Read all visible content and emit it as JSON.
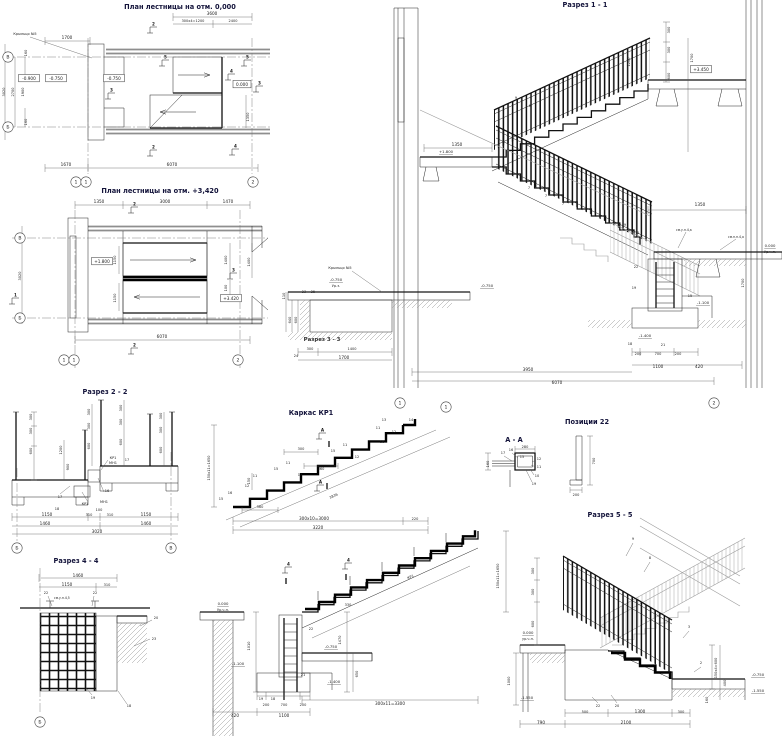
{
  "canvas": {
    "width": 782,
    "height": 737,
    "background": "#ffffff",
    "ink": "#1c1c1c",
    "wall_gray": "#8e8e8e",
    "title_color": "#13133a"
  },
  "labels": [
    {
      "t": "План лестницы на отм. 0,000",
      "x": 180,
      "y": 9,
      "c": "t",
      "n": "title-plan-0"
    },
    {
      "t": "План лестницы на отм. +3,420",
      "x": 160,
      "y": 193,
      "c": "t",
      "n": "title-plan-3420"
    },
    {
      "t": "Разрез 1 - 1",
      "x": 585,
      "y": 7,
      "c": "t",
      "n": "title-section-1-1"
    },
    {
      "t": "Разрез 2 - 2",
      "x": 105,
      "y": 394,
      "c": "t",
      "n": "title-section-2-2"
    },
    {
      "t": "Каркас КР1",
      "x": 311,
      "y": 415,
      "c": "t",
      "n": "title-frame-kr1"
    },
    {
      "t": "А - А",
      "x": 514,
      "y": 442,
      "c": "t",
      "n": "title-detail-a-a"
    },
    {
      "t": "Позиции 22",
      "x": 587,
      "y": 424,
      "c": "t",
      "n": "title-positions-22"
    },
    {
      "t": "Разрез 4 - 4",
      "x": 76,
      "y": 563,
      "c": "t",
      "n": "title-section-4-4"
    },
    {
      "t": "Разрез 5 - 5",
      "x": 610,
      "y": 517,
      "c": "t",
      "n": "title-section-5-5"
    },
    {
      "t": "Разрез 3 - 3",
      "x": 322,
      "y": 341,
      "c": "t2",
      "n": "title-section-3-3"
    },
    {
      "t": "Крыльцо №5",
      "x": 25,
      "y": 35,
      "c": "s"
    },
    {
      "t": "3600",
      "x": 212,
      "y": 15,
      "c": "d"
    },
    {
      "t": "300х4=1200",
      "x": 193,
      "y": 22,
      "c": "s"
    },
    {
      "t": "2400",
      "x": 233,
      "y": 22,
      "c": "s"
    },
    {
      "t": "1700",
      "x": 67,
      "y": 39,
      "c": "d"
    },
    {
      "t": "1670",
      "x": 66,
      "y": 166,
      "c": "d"
    },
    {
      "t": "6070",
      "x": 172,
      "y": 166,
      "c": "d"
    },
    {
      "t": "3020",
      "x": 5,
      "y": 92,
      "c": "s",
      "r": -90
    },
    {
      "t": "2700",
      "x": 14,
      "y": 92,
      "c": "s",
      "r": -90
    },
    {
      "t": "1900",
      "x": 24,
      "y": 92,
      "c": "s",
      "r": -90
    },
    {
      "t": "160",
      "x": 27,
      "y": 53,
      "c": "s",
      "r": -90
    },
    {
      "t": "160",
      "x": 27,
      "y": 122,
      "c": "s",
      "r": -90
    },
    {
      "t": "1350",
      "x": 249,
      "y": 117,
      "c": "s",
      "r": -90
    },
    {
      "t": "1350",
      "x": 99,
      "y": 203,
      "c": "d"
    },
    {
      "t": "3000",
      "x": 165,
      "y": 203,
      "c": "d"
    },
    {
      "t": "1470",
      "x": 228,
      "y": 203,
      "c": "d"
    },
    {
      "t": "1150",
      "x": 116,
      "y": 260,
      "c": "s",
      "r": -90
    },
    {
      "t": "1150",
      "x": 116,
      "y": 298,
      "c": "s",
      "r": -90
    },
    {
      "t": "1400",
      "x": 227,
      "y": 260,
      "c": "s",
      "r": -90
    },
    {
      "t": "1400",
      "x": 250,
      "y": 262,
      "c": "s",
      "r": -90
    },
    {
      "t": "100",
      "x": 227,
      "y": 288,
      "c": "s",
      "r": -90
    },
    {
      "t": "3020",
      "x": 21,
      "y": 276,
      "c": "s",
      "r": -90
    },
    {
      "t": "6070",
      "x": 162,
      "y": 338,
      "c": "d"
    },
    {
      "t": "1350",
      "x": 457,
      "y": 146,
      "c": "d"
    },
    {
      "t": "+1.800",
      "x": 446,
      "y": 153,
      "c": "e"
    },
    {
      "t": "0.000",
      "x": 770,
      "y": 247,
      "c": "e"
    },
    {
      "t": "Ур.ч.п.",
      "x": 770,
      "y": 253,
      "c": "s"
    },
    {
      "t": "1350",
      "x": 700,
      "y": 206,
      "c": "d"
    },
    {
      "t": "см.у.п.4,а",
      "x": 676,
      "y": 231,
      "c": "n"
    },
    {
      "t": "см.п.п.4,а",
      "x": 728,
      "y": 238,
      "c": "n"
    },
    {
      "t": "Крыльцо №5",
      "x": 340,
      "y": 269,
      "c": "s"
    },
    {
      "t": "-0.750",
      "x": 336,
      "y": 281,
      "c": "e"
    },
    {
      "t": "Ур.з.",
      "x": 336,
      "y": 287,
      "c": "s"
    },
    {
      "t": "-0.750",
      "x": 487,
      "y": 287,
      "c": "e"
    },
    {
      "t": "300",
      "x": 310,
      "y": 350,
      "c": "s"
    },
    {
      "t": "1400",
      "x": 352,
      "y": 350,
      "c": "s"
    },
    {
      "t": "1700",
      "x": 344,
      "y": 359,
      "c": "d"
    },
    {
      "t": "110",
      "x": 285,
      "y": 296,
      "c": "s",
      "r": -90
    },
    {
      "t": "640",
      "x": 291,
      "y": 320,
      "c": "s",
      "r": -90
    },
    {
      "t": "600",
      "x": 297,
      "y": 320,
      "c": "s",
      "r": -90
    },
    {
      "t": "23",
      "x": 304,
      "y": 293,
      "c": "s"
    },
    {
      "t": "25",
      "x": 313,
      "y": 293,
      "c": "s"
    },
    {
      "t": "24",
      "x": 296,
      "y": 357,
      "c": "s"
    },
    {
      "t": "-1.100",
      "x": 703,
      "y": 304,
      "c": "e"
    },
    {
      "t": "-1.400",
      "x": 645,
      "y": 337,
      "c": "e"
    },
    {
      "t": "200",
      "x": 638,
      "y": 355,
      "c": "s"
    },
    {
      "t": "700",
      "x": 658,
      "y": 355,
      "c": "s"
    },
    {
      "t": "200",
      "x": 678,
      "y": 355,
      "c": "s"
    },
    {
      "t": "1100",
      "x": 658,
      "y": 368,
      "c": "d"
    },
    {
      "t": "420",
      "x": 699,
      "y": 368,
      "c": "d"
    },
    {
      "t": "3950",
      "x": 528,
      "y": 371,
      "c": "d"
    },
    {
      "t": "6070",
      "x": 557,
      "y": 384,
      "c": "d"
    },
    {
      "t": "300",
      "x": 670,
      "y": 30,
      "c": "s",
      "r": -90
    },
    {
      "t": "300",
      "x": 670,
      "y": 50,
      "c": "s",
      "r": -90
    },
    {
      "t": "600",
      "x": 670,
      "y": 76,
      "c": "s",
      "r": -90
    },
    {
      "t": "1700",
      "x": 693,
      "y": 58,
      "c": "s",
      "r": -90
    },
    {
      "t": "1200",
      "x": 630,
      "y": 62,
      "c": "s",
      "r": -90
    },
    {
      "t": "1700",
      "x": 744,
      "y": 283,
      "c": "s",
      "r": -90
    },
    {
      "t": "9",
      "x": 516,
      "y": 99,
      "c": "s"
    },
    {
      "t": "8",
      "x": 530,
      "y": 107,
      "c": "s"
    },
    {
      "t": "9",
      "x": 625,
      "y": 226,
      "c": "s"
    },
    {
      "t": "8",
      "x": 638,
      "y": 234,
      "c": "s"
    },
    {
      "t": "7",
      "x": 529,
      "y": 189,
      "c": "s"
    },
    {
      "t": "7",
      "x": 546,
      "y": 197,
      "c": "s"
    },
    {
      "t": "7",
      "x": 563,
      "y": 205,
      "c": "s"
    },
    {
      "t": "22",
      "x": 636,
      "y": 268,
      "c": "s"
    },
    {
      "t": "19",
      "x": 634,
      "y": 289,
      "c": "s"
    },
    {
      "t": "15",
      "x": 690,
      "y": 297,
      "c": "s"
    },
    {
      "t": "21",
      "x": 663,
      "y": 346,
      "c": "s"
    },
    {
      "t": "18",
      "x": 630,
      "y": 345,
      "c": "s"
    },
    {
      "t": "300",
      "x": 32,
      "y": 417,
      "c": "s",
      "r": -90
    },
    {
      "t": "300",
      "x": 32,
      "y": 431,
      "c": "s",
      "r": -90
    },
    {
      "t": "600",
      "x": 32,
      "y": 451,
      "c": "s",
      "r": -90
    },
    {
      "t": "1200",
      "x": 62,
      "y": 450,
      "c": "s",
      "r": -90
    },
    {
      "t": "900",
      "x": 69,
      "y": 467,
      "c": "s",
      "r": -90
    },
    {
      "t": "300",
      "x": 90,
      "y": 412,
      "c": "s",
      "r": -90
    },
    {
      "t": "300",
      "x": 90,
      "y": 426,
      "c": "s",
      "r": -90
    },
    {
      "t": "600",
      "x": 90,
      "y": 446,
      "c": "s",
      "r": -90
    },
    {
      "t": "300",
      "x": 122,
      "y": 408,
      "c": "s",
      "r": -90
    },
    {
      "t": "300",
      "x": 122,
      "y": 422,
      "c": "s",
      "r": -90
    },
    {
      "t": "600",
      "x": 122,
      "y": 442,
      "c": "s",
      "r": -90
    },
    {
      "t": "300",
      "x": 162,
      "y": 416,
      "c": "s",
      "r": -90
    },
    {
      "t": "300",
      "x": 162,
      "y": 430,
      "c": "s",
      "r": -90
    },
    {
      "t": "600",
      "x": 162,
      "y": 450,
      "c": "s",
      "r": -90
    },
    {
      "t": "КР1",
      "x": 113,
      "y": 459,
      "c": "s"
    },
    {
      "t": "МН1",
      "x": 113,
      "y": 464,
      "c": "s"
    },
    {
      "t": "17",
      "x": 127,
      "y": 461,
      "c": "s"
    },
    {
      "t": "16",
      "x": 107,
      "y": 492,
      "c": "s"
    },
    {
      "t": "МН1",
      "x": 104,
      "y": 503,
      "c": "s"
    },
    {
      "t": "КР1",
      "x": 85,
      "y": 505,
      "c": "s"
    },
    {
      "t": "17",
      "x": 60,
      "y": 498,
      "c": "s"
    },
    {
      "t": "18",
      "x": 57,
      "y": 510,
      "c": "s"
    },
    {
      "t": "1150",
      "x": 47,
      "y": 516,
      "c": "d"
    },
    {
      "t": "310",
      "x": 89,
      "y": 516,
      "c": "s"
    },
    {
      "t": "100",
      "x": 99,
      "y": 511,
      "c": "s"
    },
    {
      "t": "310",
      "x": 110,
      "y": 516,
      "c": "s"
    },
    {
      "t": "1150",
      "x": 146,
      "y": 516,
      "c": "d"
    },
    {
      "t": "1460",
      "x": 45,
      "y": 525,
      "c": "d"
    },
    {
      "t": "1460",
      "x": 146,
      "y": 525,
      "c": "d"
    },
    {
      "t": "3020",
      "x": 97,
      "y": 533,
      "c": "d"
    },
    {
      "t": "150х11=1650",
      "x": 210,
      "y": 468,
      "c": "s",
      "r": -90
    },
    {
      "t": "300х10=3000",
      "x": 314,
      "y": 520,
      "c": "d"
    },
    {
      "t": "3220",
      "x": 318,
      "y": 529,
      "c": "d"
    },
    {
      "t": "220",
      "x": 415,
      "y": 520,
      "c": "s"
    },
    {
      "t": "3836",
      "x": 334,
      "y": 497,
      "c": "s",
      "r": -24
    },
    {
      "t": "300",
      "x": 301,
      "y": 450,
      "c": "s"
    },
    {
      "t": "360",
      "x": 321,
      "y": 470,
      "c": "s"
    },
    {
      "t": "360",
      "x": 260,
      "y": 508,
      "c": "s"
    },
    {
      "t": "150",
      "x": 250,
      "y": 481,
      "c": "s",
      "r": -90
    },
    {
      "t": "15",
      "x": 221,
      "y": 500,
      "c": "s"
    },
    {
      "t": "16",
      "x": 230,
      "y": 494,
      "c": "s"
    },
    {
      "t": "12",
      "x": 247,
      "y": 487,
      "c": "s"
    },
    {
      "t": "11",
      "x": 255,
      "y": 477,
      "c": "s"
    },
    {
      "t": "15",
      "x": 276,
      "y": 470,
      "c": "s"
    },
    {
      "t": "11",
      "x": 288,
      "y": 464,
      "c": "s"
    },
    {
      "t": "12",
      "x": 300,
      "y": 476,
      "c": "s"
    },
    {
      "t": "15",
      "x": 333,
      "y": 452,
      "c": "s"
    },
    {
      "t": "11",
      "x": 345,
      "y": 446,
      "c": "s"
    },
    {
      "t": "12",
      "x": 357,
      "y": 458,
      "c": "s"
    },
    {
      "t": "13",
      "x": 384,
      "y": 421,
      "c": "s"
    },
    {
      "t": "11",
      "x": 378,
      "y": 429,
      "c": "s"
    },
    {
      "t": "12",
      "x": 394,
      "y": 433,
      "c": "s"
    },
    {
      "t": "14",
      "x": 411,
      "y": 421,
      "c": "s"
    },
    {
      "t": "16",
      "x": 382,
      "y": 443,
      "c": "s"
    },
    {
      "t": "280",
      "x": 525,
      "y": 448,
      "c": "s"
    },
    {
      "t": "160",
      "x": 489,
      "y": 464,
      "c": "s",
      "r": -90
    },
    {
      "t": "17",
      "x": 503,
      "y": 454,
      "c": "s"
    },
    {
      "t": "16",
      "x": 511,
      "y": 451,
      "c": "s"
    },
    {
      "t": "15",
      "x": 522,
      "y": 458,
      "c": "s"
    },
    {
      "t": "12",
      "x": 539,
      "y": 460,
      "c": "s"
    },
    {
      "t": "11",
      "x": 539,
      "y": 468,
      "c": "s"
    },
    {
      "t": "10",
      "x": 537,
      "y": 477,
      "c": "s"
    },
    {
      "t": "19",
      "x": 534,
      "y": 485,
      "c": "s"
    },
    {
      "t": "700",
      "x": 595,
      "y": 461,
      "c": "s",
      "r": -90
    },
    {
      "t": "200",
      "x": 576,
      "y": 496,
      "c": "s"
    },
    {
      "t": "0.000",
      "x": 223,
      "y": 605,
      "c": "e"
    },
    {
      "t": "Ур.ч.п.",
      "x": 223,
      "y": 611,
      "c": "s"
    },
    {
      "t": "-1.100",
      "x": 238,
      "y": 665,
      "c": "e"
    },
    {
      "t": "-0.750",
      "x": 331,
      "y": 648,
      "c": "e"
    },
    {
      "t": "-1.400",
      "x": 334,
      "y": 683,
      "c": "e"
    },
    {
      "t": "1010",
      "x": 250,
      "y": 646,
      "c": "s",
      "r": -90
    },
    {
      "t": "1470",
      "x": 341,
      "y": 640,
      "c": "s",
      "r": -90
    },
    {
      "t": "650",
      "x": 358,
      "y": 674,
      "c": "s",
      "r": -90
    },
    {
      "t": "330",
      "x": 348,
      "y": 606,
      "c": "s"
    },
    {
      "t": "200",
      "x": 266,
      "y": 706,
      "c": "s"
    },
    {
      "t": "700",
      "x": 284,
      "y": 706,
      "c": "s"
    },
    {
      "t": "200",
      "x": 303,
      "y": 706,
      "c": "s"
    },
    {
      "t": "420",
      "x": 235,
      "y": 717,
      "c": "d"
    },
    {
      "t": "1100",
      "x": 284,
      "y": 717,
      "c": "d"
    },
    {
      "t": "300х11=3300",
      "x": 390,
      "y": 705,
      "c": "d"
    },
    {
      "t": "150х11=1650",
      "x": 499,
      "y": 576,
      "c": "s",
      "r": -90
    },
    {
      "t": "КР1",
      "x": 411,
      "y": 578,
      "c": "s",
      "r": -24
    },
    {
      "t": "1000",
      "x": 510,
      "y": 681,
      "c": "s",
      "r": -90
    },
    {
      "t": "22",
      "x": 311,
      "y": 630,
      "c": "s"
    },
    {
      "t": "19",
      "x": 261,
      "y": 700,
      "c": "s"
    },
    {
      "t": "18",
      "x": 273,
      "y": 700,
      "c": "s"
    },
    {
      "t": "21",
      "x": 303,
      "y": 676,
      "c": "s"
    },
    {
      "t": "1460",
      "x": 78,
      "y": 577,
      "c": "d"
    },
    {
      "t": "1150",
      "x": 67,
      "y": 586,
      "c": "d"
    },
    {
      "t": "310",
      "x": 107,
      "y": 586,
      "c": "s"
    },
    {
      "t": "22",
      "x": 46,
      "y": 594,
      "c": "s"
    },
    {
      "t": "см.у.п.4,5",
      "x": 54,
      "y": 599,
      "c": "n"
    },
    {
      "t": "22",
      "x": 95,
      "y": 594,
      "c": "s"
    },
    {
      "t": "20",
      "x": 156,
      "y": 619,
      "c": "s"
    },
    {
      "t": "23",
      "x": 154,
      "y": 640,
      "c": "s"
    },
    {
      "t": "19",
      "x": 93,
      "y": 699,
      "c": "s"
    },
    {
      "t": "18",
      "x": 129,
      "y": 707,
      "c": "s"
    },
    {
      "t": "300",
      "x": 534,
      "y": 571,
      "c": "s",
      "r": -90
    },
    {
      "t": "300",
      "x": 534,
      "y": 592,
      "c": "s",
      "r": -90
    },
    {
      "t": "600",
      "x": 534,
      "y": 624,
      "c": "s",
      "r": -90
    },
    {
      "t": "0.000",
      "x": 528,
      "y": 634,
      "c": "e"
    },
    {
      "t": "ур.ч.п.",
      "x": 528,
      "y": 640,
      "c": "s"
    },
    {
      "t": "-1.550",
      "x": 527,
      "y": 699,
      "c": "e"
    },
    {
      "t": "-0.750",
      "x": 758,
      "y": 676,
      "c": "e"
    },
    {
      "t": "-1.550",
      "x": 758,
      "y": 692,
      "c": "e"
    },
    {
      "t": "150х4=600",
      "x": 717,
      "y": 668,
      "c": "s",
      "r": -90
    },
    {
      "t": "400",
      "x": 726,
      "y": 683,
      "c": "s",
      "r": -90
    },
    {
      "t": "160",
      "x": 708,
      "y": 700,
      "c": "s",
      "r": -90
    },
    {
      "t": "500",
      "x": 585,
      "y": 713,
      "c": "s"
    },
    {
      "t": "1300",
      "x": 640,
      "y": 713,
      "c": "d"
    },
    {
      "t": "300",
      "x": 681,
      "y": 713,
      "c": "s"
    },
    {
      "t": "790",
      "x": 541,
      "y": 724,
      "c": "d"
    },
    {
      "t": "2100",
      "x": 626,
      "y": 724,
      "c": "d"
    },
    {
      "t": "9",
      "x": 633,
      "y": 540,
      "c": "s"
    },
    {
      "t": "8",
      "x": 650,
      "y": 559,
      "c": "s"
    },
    {
      "t": "3",
      "x": 689,
      "y": 628,
      "c": "s"
    },
    {
      "t": "2",
      "x": 701,
      "y": 664,
      "c": "s"
    },
    {
      "t": "22",
      "x": 598,
      "y": 707,
      "c": "s"
    },
    {
      "t": "20",
      "x": 617,
      "y": 707,
      "c": "s"
    }
  ],
  "boxed": [
    {
      "t": "-0.900",
      "x": 29,
      "y": 80
    },
    {
      "t": "-0.750",
      "x": 56,
      "y": 80
    },
    {
      "t": "-0.750",
      "x": 114,
      "y": 80
    },
    {
      "t": "0.000",
      "x": 242,
      "y": 86
    },
    {
      "t": "+1.800",
      "x": 102,
      "y": 263
    },
    {
      "t": "+3.420",
      "x": 231,
      "y": 300
    },
    {
      "t": "+3.450",
      "x": 701,
      "y": 71
    }
  ],
  "bubbles": [
    {
      "t": "В",
      "x": 8,
      "y": 57
    },
    {
      "t": "Б",
      "x": 8,
      "y": 127
    },
    {
      "t": "1",
      "x": 76,
      "y": 182
    },
    {
      "t": "1",
      "x": 86,
      "y": 182
    },
    {
      "t": "2",
      "x": 253,
      "y": 182
    },
    {
      "t": "В",
      "x": 20,
      "y": 238
    },
    {
      "t": "Б",
      "x": 20,
      "y": 318
    },
    {
      "t": "1",
      "x": 64,
      "y": 360
    },
    {
      "t": "1",
      "x": 74,
      "y": 360
    },
    {
      "t": "2",
      "x": 238,
      "y": 360
    },
    {
      "t": "1",
      "x": 400,
      "y": 403
    },
    {
      "t": "2",
      "x": 714,
      "y": 403
    },
    {
      "t": "1",
      "x": 446,
      "y": 407
    },
    {
      "t": "Б",
      "x": 17,
      "y": 548
    },
    {
      "t": "В",
      "x": 171,
      "y": 548
    },
    {
      "t": "Б",
      "x": 40,
      "y": 722
    }
  ],
  "flags": [
    {
      "t": "2",
      "x": 150,
      "y": 33
    },
    {
      "t": "2",
      "x": 150,
      "y": 156
    },
    {
      "t": "5",
      "x": 162,
      "y": 66
    },
    {
      "t": "5",
      "x": 244,
      "y": 66
    },
    {
      "t": "4",
      "x": 228,
      "y": 80
    },
    {
      "t": "4",
      "x": 232,
      "y": 155
    },
    {
      "t": "3",
      "x": 108,
      "y": 99
    },
    {
      "t": "3",
      "x": 256,
      "y": 92
    },
    {
      "t": "2",
      "x": 131,
      "y": 213
    },
    {
      "t": "2",
      "x": 131,
      "y": 354
    },
    {
      "t": "3",
      "x": 230,
      "y": 279
    },
    {
      "t": "1",
      "x": 12,
      "y": 304
    },
    {
      "t": "А",
      "x": 319,
      "y": 439
    },
    {
      "t": "А",
      "x": 317,
      "y": 491
    },
    {
      "t": "4",
      "x": 285,
      "y": 573
    },
    {
      "t": "4",
      "x": 345,
      "y": 569
    }
  ]
}
